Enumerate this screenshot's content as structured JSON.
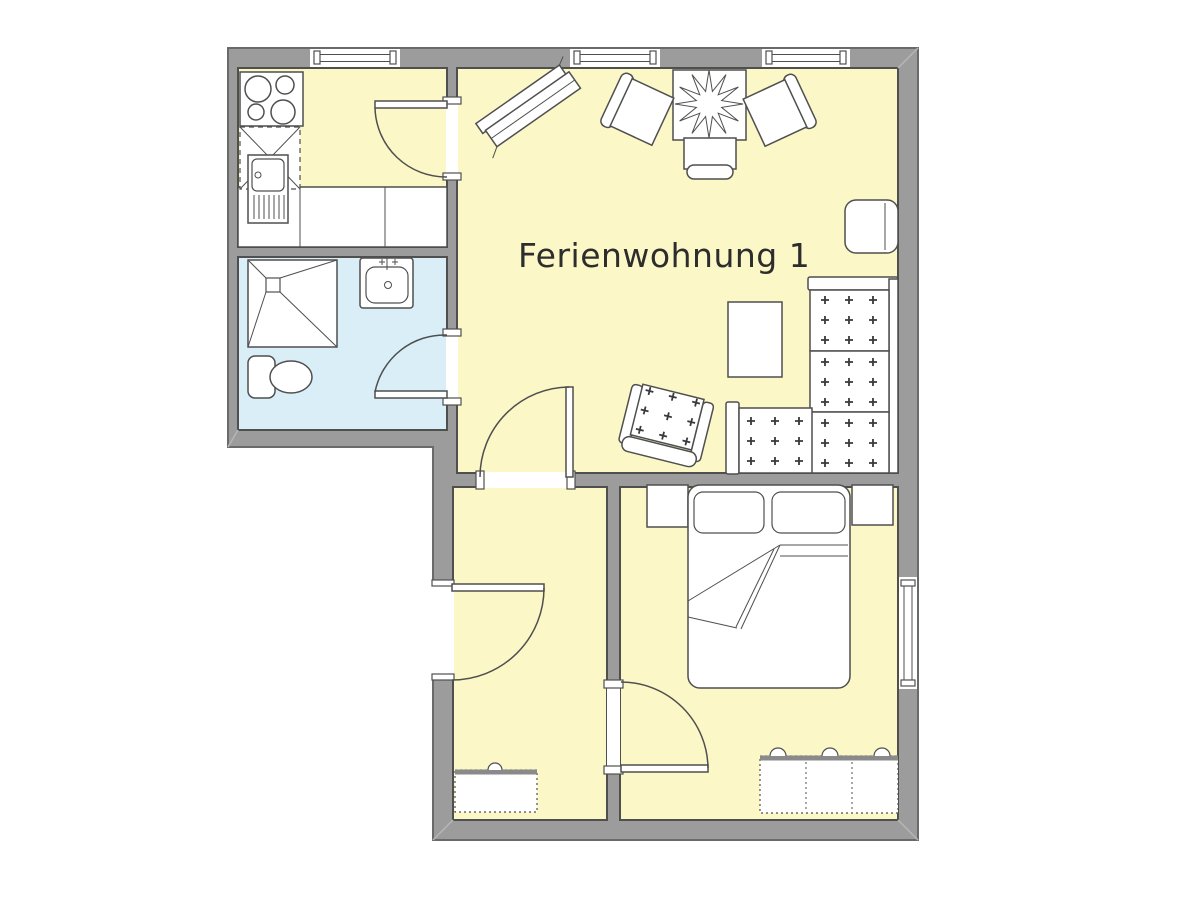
{
  "label": {
    "text": "Ferienwohnung 1"
  },
  "colors": {
    "background": "#ffffff",
    "wall": "#9c9c9c",
    "floor_main": "#fbf7c6",
    "floor_bath": "#d9eef7",
    "line": "#4f4f4f",
    "outline": "#6a6a6a",
    "text": "#2d2d2d"
  },
  "rooms": [
    {
      "id": "kitchen",
      "floor": "floor_main"
    },
    {
      "id": "bathroom",
      "floor": "floor_bath"
    },
    {
      "id": "living-room",
      "floor": "floor_main"
    },
    {
      "id": "small-room",
      "floor": "floor_main"
    },
    {
      "id": "bedroom",
      "floor": "floor_main"
    }
  ],
  "fixtures": {
    "stove": "cooktop-4-burners",
    "kitchen_corner_cabinet": "dashed-corner-unit",
    "kitchen_sink": "sink-with-drainboard",
    "kitchen_counter": "counter-run",
    "shower": "corner-shower",
    "washbasin": "basin-with-tap",
    "toilet": "wc",
    "tv_board": "angled-sideboard",
    "dining_table": "square-table-with-plant",
    "chairs": "3-dining-chairs",
    "side_seat": "stool",
    "coffee_table": "rectangular-table",
    "armchair": "upholstered-armchair",
    "sofa": "l-shaped-corner-sofa",
    "bed": "double-bed-with-pillows",
    "nightstands": "2-bedside-tables",
    "wardrobe": "3-door-wardrobe",
    "radiators": "2-radiators",
    "windows": "4-windows",
    "doors": "5-swing-doors"
  }
}
